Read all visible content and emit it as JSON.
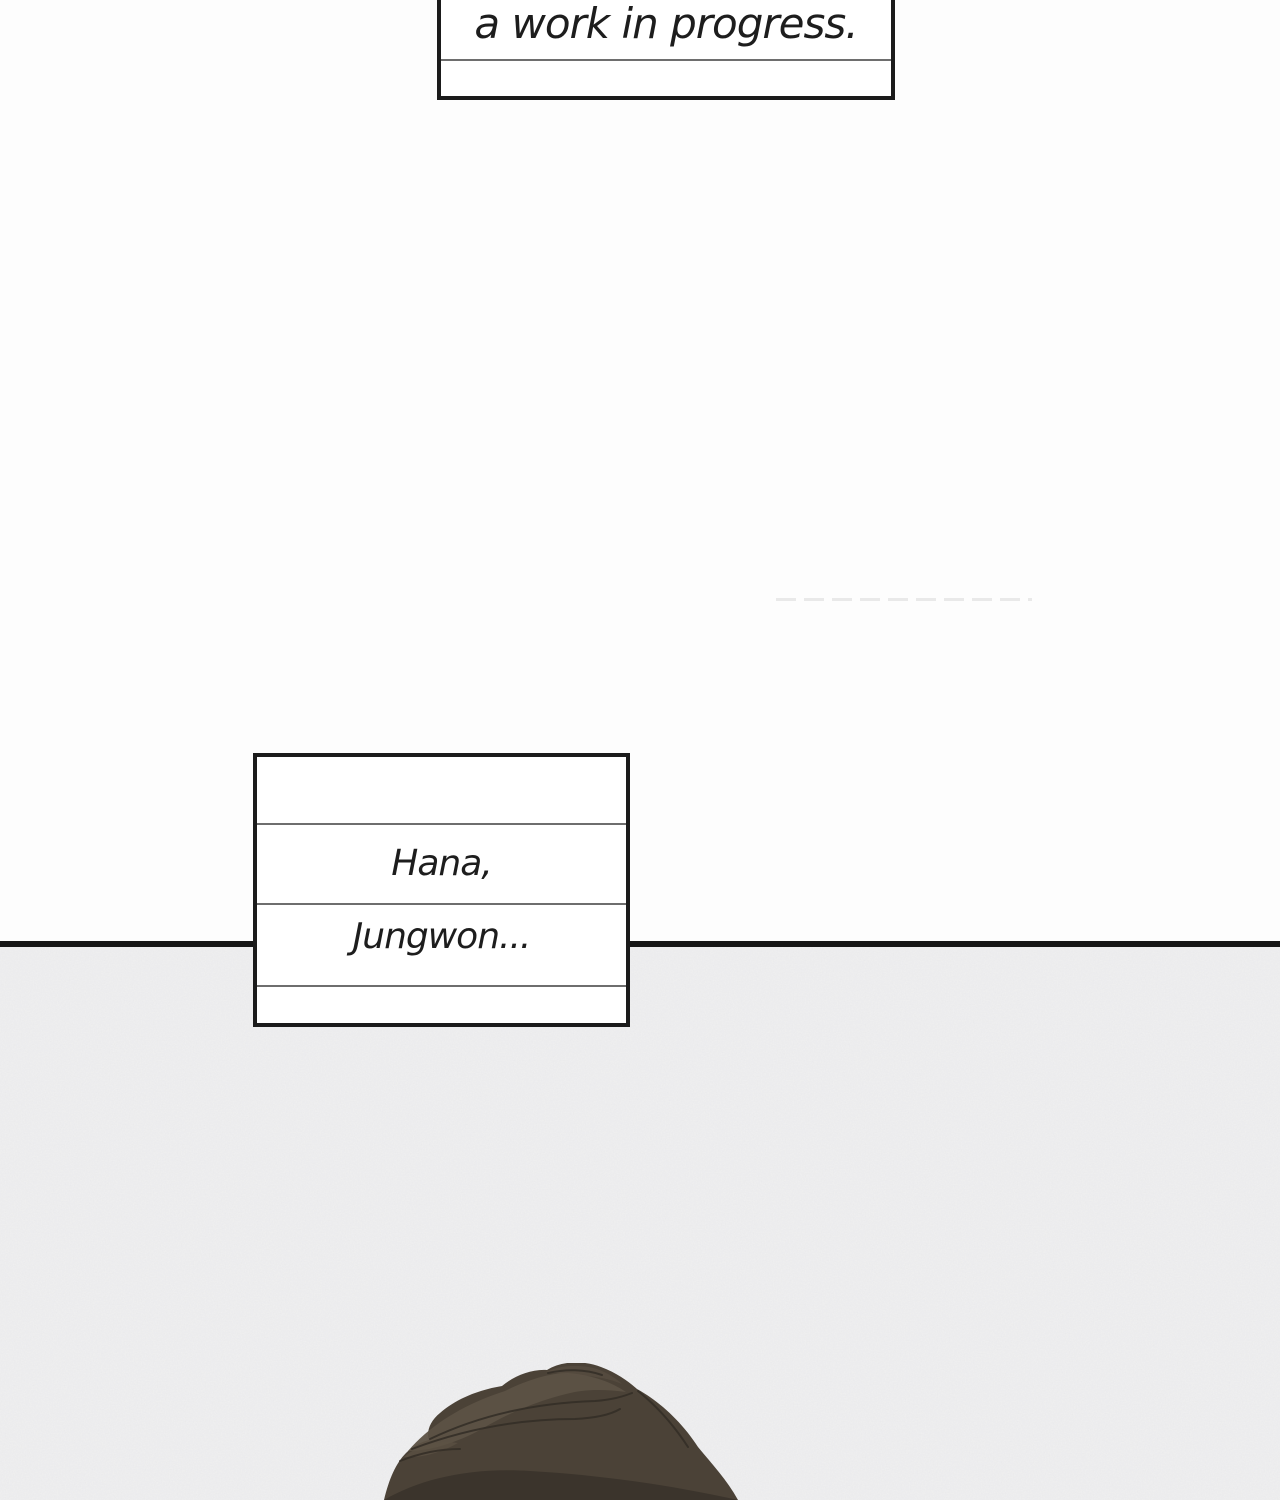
{
  "comic": {
    "top_caption": {
      "text": "a work in progress."
    },
    "middle_caption": {
      "line1": "Hana,",
      "line2": "Jungwon..."
    }
  },
  "colors": {
    "page_bg": "#fdfdfd",
    "panel_bg": "#ebebec",
    "line_black": "#161616",
    "note_border": "#1b1b1b",
    "note_divider": "#6e6e6e",
    "text": "#1d1d1d",
    "hair_base": "#4b4237",
    "hair_highlight": "#5c5245",
    "hair_shadow": "#3a332b",
    "hair_stroke": "#332d26",
    "faint_line": "#e7e7e7"
  }
}
